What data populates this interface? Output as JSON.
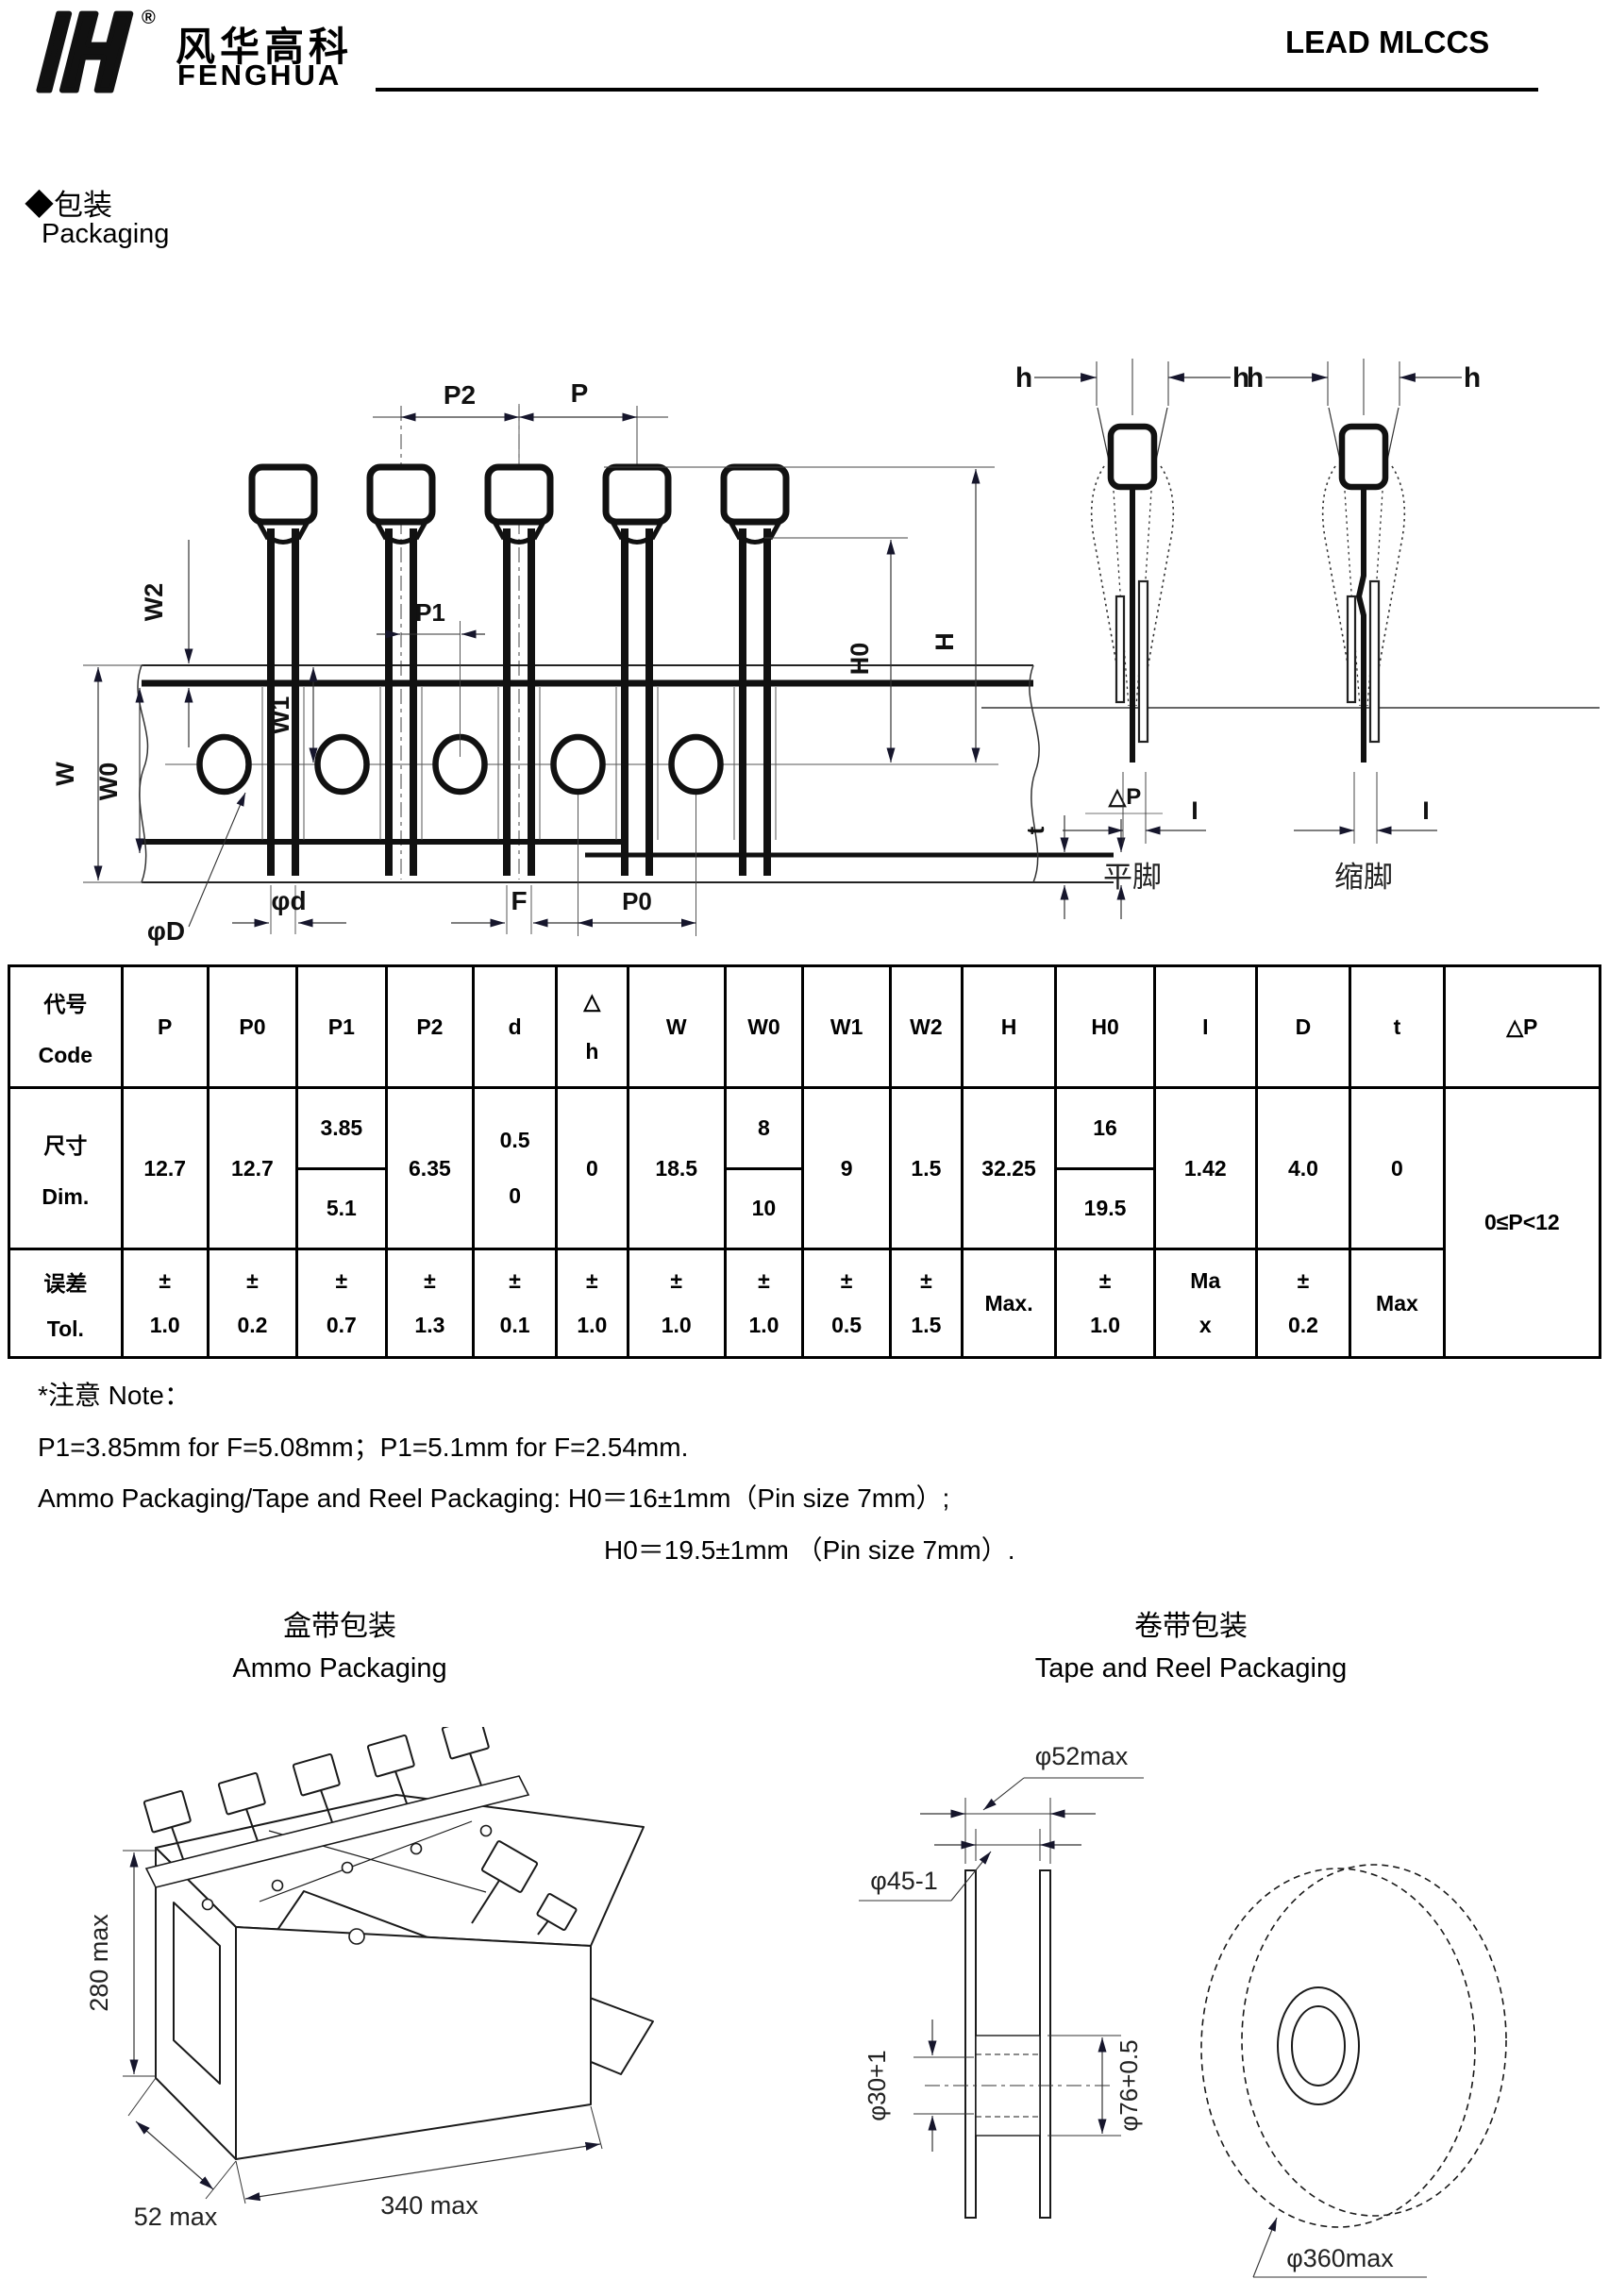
{
  "header": {
    "brand_cn": "风华高科",
    "brand_en": "FENGHUA",
    "reg": "®",
    "doc_title": "LEAD MLCCS"
  },
  "section": {
    "title_cn": "◆包装",
    "title_en": "Packaging"
  },
  "diagram": {
    "p2": "P2",
    "p": "P",
    "p1": "P1",
    "w2": "W2",
    "w": "W",
    "w0": "W0",
    "w1": "W1",
    "h0": "H0",
    "h_big": "H",
    "phi_D": "φD",
    "phi_d": "φd",
    "f": "F",
    "p0": "P0",
    "t": "t",
    "delta_p": "△P",
    "h_small": "h",
    "i": "I",
    "flat_leg": "平脚",
    "crimped_leg": "缩脚"
  },
  "table": {
    "corner_cn": "代号",
    "corner_en": "Code",
    "dim_cn": "尺寸",
    "dim_en": "Dim.",
    "tol_cn": "误差",
    "tol_en": "Tol.",
    "columns": [
      {
        "code": "P",
        "dim": "12.7",
        "tol_sign": "±",
        "tol": "1.0"
      },
      {
        "code": "P0",
        "dim": "12.7",
        "tol_sign": "±",
        "tol": "0.2"
      },
      {
        "code": "P1",
        "dim_top": "3.85",
        "dim_bottom": "5.1",
        "tol_sign": "±",
        "tol": "0.7"
      },
      {
        "code": "P2",
        "dim": "6.35",
        "tol_sign": "±",
        "tol": "1.3"
      },
      {
        "code": "d",
        "dim_line1": "0.5",
        "dim_line2": "0",
        "tol_sign": "±",
        "tol": "0.1"
      },
      {
        "code_line1": "△",
        "code_line2": "h",
        "dim": "0",
        "tol_sign": "±",
        "tol": "1.0"
      },
      {
        "code": "W",
        "dim": "18.5",
        "tol_sign": "±",
        "tol": "1.0"
      },
      {
        "code": "W0",
        "dim_top": "8",
        "dim_bottom": "10",
        "tol_sign": "±",
        "tol": "1.0"
      },
      {
        "code": "W1",
        "dim": "9",
        "tol_sign": "±",
        "tol": "0.5"
      },
      {
        "code": "W2",
        "dim": "1.5",
        "tol_sign": "±",
        "tol": "1.5"
      },
      {
        "code": "H",
        "dim": "32.25",
        "tol": "Max."
      },
      {
        "code": "H0",
        "dim_top": "16",
        "dim_bottom": "19.5",
        "tol_sign": "±",
        "tol": "1.0"
      },
      {
        "code": "I",
        "dim": "1.42",
        "tol_line1": "Ma",
        "tol_line2": "x"
      },
      {
        "code": "D",
        "dim": "4.0",
        "tol_sign": "±",
        "tol": "0.2"
      },
      {
        "code": "t",
        "dim": "0",
        "tol": "Max"
      },
      {
        "code": "△P",
        "range": "0≤P<12"
      }
    ]
  },
  "notes": {
    "title": "*注意 Note：",
    "line1": "P1=3.85mm for F=5.08mm；P1=5.1mm for F=2.54mm.",
    "line2": "Ammo Packaging/Tape and Reel Packaging: H0＝16±1mm（Pin size 7mm）;",
    "line3": "H0＝19.5±1mm （Pin size 7mm）."
  },
  "ammo": {
    "title_cn": "盒带包装",
    "title_en": "Ammo Packaging",
    "dim_height": "280 max",
    "dim_depth": "52 max",
    "dim_width": "340 max"
  },
  "reel": {
    "title_cn": "卷带包装",
    "title_en": "Tape and Reel Packaging",
    "d52": "φ52max",
    "d45": "φ45-1",
    "d30": "φ30+1",
    "d76": "φ76+0.5",
    "d360": "φ360max"
  }
}
